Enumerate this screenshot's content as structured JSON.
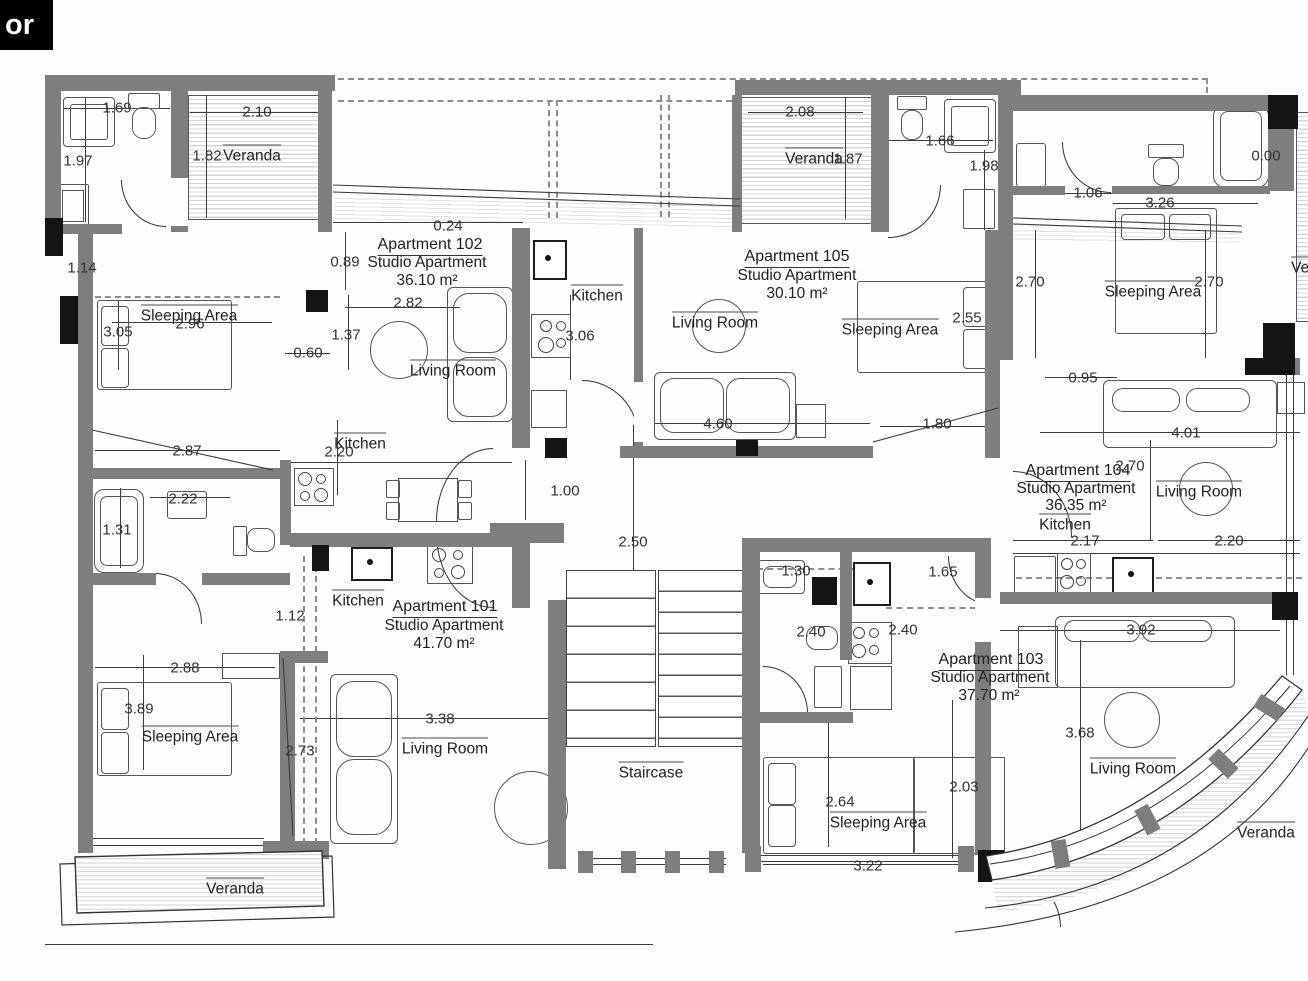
{
  "title_box": {
    "label": "or"
  },
  "apartments": [
    {
      "name": "Apartment 101",
      "type": "Studio Apartment",
      "area": "41.70 m²"
    },
    {
      "name": "Apartment 102",
      "type": "Studio Apartment",
      "area": "36.10 m²"
    },
    {
      "name": "Apartment 103",
      "type": "Studio Apartment",
      "area": "37.70 m²"
    },
    {
      "name": "Apartment 104",
      "type": "Studio Apartment",
      "area": "36.35 m²"
    },
    {
      "name": "Apartment 105",
      "type": "Studio Apartment",
      "area": "30.10 m²"
    }
  ],
  "room_types": [
    "Kitchen",
    "Living Room",
    "Sleeping Area",
    "Veranda",
    "Staircase"
  ],
  "labels": [
    {
      "t": "Apartment 102",
      "x": 430,
      "y": 246,
      "c": "apt"
    },
    {
      "t": "Studio Apartment",
      "x": 427,
      "y": 263,
      "c": "sub"
    },
    {
      "t": "36.10 m²",
      "x": 427,
      "y": 281,
      "c": "sub"
    },
    {
      "t": "Apartment 105",
      "x": 797,
      "y": 258,
      "c": "apt"
    },
    {
      "t": "Studio Apartment",
      "x": 797,
      "y": 276,
      "c": "sub"
    },
    {
      "t": "30.10 m²",
      "x": 797,
      "y": 294,
      "c": "sub"
    },
    {
      "t": "Apartment 104",
      "x": 1078,
      "y": 472,
      "c": "apt"
    },
    {
      "t": "Studio Apartment",
      "x": 1076,
      "y": 489,
      "c": "sub"
    },
    {
      "t": "36.35 m²",
      "x": 1076,
      "y": 506,
      "c": "sub"
    },
    {
      "t": "Apartment 101",
      "x": 445,
      "y": 608,
      "c": "apt"
    },
    {
      "t": "Studio Apartment",
      "x": 444,
      "y": 626,
      "c": "sub"
    },
    {
      "t": "41.70 m²",
      "x": 444,
      "y": 644,
      "c": "sub"
    },
    {
      "t": "Apartment 103",
      "x": 991,
      "y": 661,
      "c": "apt"
    },
    {
      "t": "Studio Apartment",
      "x": 990,
      "y": 678,
      "c": "sub"
    },
    {
      "t": "37.70 m²",
      "x": 989,
      "y": 696,
      "c": "sub"
    },
    {
      "t": "Veranda",
      "x": 252,
      "y": 155,
      "c": "room"
    },
    {
      "t": "Veranda",
      "x": 814,
      "y": 158,
      "c": "room"
    },
    {
      "t": "Veranda",
      "x": 235,
      "y": 888,
      "c": "room"
    },
    {
      "t": "Veranda",
      "x": 1266,
      "y": 832,
      "c": "room"
    },
    {
      "t": "Veranda",
      "x": 1320,
      "y": 267,
      "c": "room"
    },
    {
      "t": "Kitchen",
      "x": 597,
      "y": 295,
      "c": "room"
    },
    {
      "t": "Kitchen",
      "x": 360,
      "y": 443,
      "c": "room"
    },
    {
      "t": "Kitchen",
      "x": 358,
      "y": 600,
      "c": "room"
    },
    {
      "t": "Kitchen",
      "x": 1065,
      "y": 524,
      "c": "room"
    },
    {
      "t": "Living Room",
      "x": 453,
      "y": 370,
      "c": "room"
    },
    {
      "t": "Living Room",
      "x": 715,
      "y": 322,
      "c": "room"
    },
    {
      "t": "Living Room",
      "x": 1199,
      "y": 491,
      "c": "room"
    },
    {
      "t": "Living Room",
      "x": 445,
      "y": 748,
      "c": "room"
    },
    {
      "t": "Living Room",
      "x": 1133,
      "y": 768,
      "c": "room"
    },
    {
      "t": "Sleeping Area",
      "x": 189,
      "y": 315,
      "c": "room"
    },
    {
      "t": "Sleeping Area",
      "x": 890,
      "y": 329,
      "c": "room"
    },
    {
      "t": "Sleeping Area",
      "x": 1153,
      "y": 291,
      "c": "room"
    },
    {
      "t": "Sleeping Area",
      "x": 190,
      "y": 736,
      "c": "room"
    },
    {
      "t": "Sleeping Area",
      "x": 878,
      "y": 822,
      "c": "room"
    },
    {
      "t": "Staircase",
      "x": 651,
      "y": 772,
      "c": "room"
    },
    {
      "t": "1.69",
      "x": 117,
      "y": 108,
      "c": "dim"
    },
    {
      "t": "2.10",
      "x": 257,
      "y": 112,
      "c": "dim"
    },
    {
      "t": "1.82",
      "x": 207,
      "y": 156,
      "c": "dim"
    },
    {
      "t": "1.97",
      "x": 78,
      "y": 161,
      "c": "dim"
    },
    {
      "t": "1.14",
      "x": 82,
      "y": 268,
      "c": "dim"
    },
    {
      "t": "0.24",
      "x": 448,
      "y": 226,
      "c": "dim"
    },
    {
      "t": "0.89",
      "x": 345,
      "y": 262,
      "c": "dim"
    },
    {
      "t": "2.82",
      "x": 408,
      "y": 303,
      "c": "dim"
    },
    {
      "t": "1.37",
      "x": 346,
      "y": 335,
      "c": "dim"
    },
    {
      "t": "0.60",
      "x": 308,
      "y": 353,
      "c": "dim"
    },
    {
      "t": "3.05",
      "x": 118,
      "y": 332,
      "c": "dim"
    },
    {
      "t": "2.96",
      "x": 190,
      "y": 324,
      "c": "dim"
    },
    {
      "t": "3.06",
      "x": 580,
      "y": 336,
      "c": "dim"
    },
    {
      "t": "2.87",
      "x": 187,
      "y": 451,
      "c": "dim"
    },
    {
      "t": "2.20",
      "x": 339,
      "y": 452,
      "c": "dim"
    },
    {
      "t": "2.22",
      "x": 183,
      "y": 499,
      "c": "dim"
    },
    {
      "t": "1.31",
      "x": 117,
      "y": 530,
      "c": "dim"
    },
    {
      "t": "1.12",
      "x": 290,
      "y": 616,
      "c": "dim"
    },
    {
      "t": "2.88",
      "x": 185,
      "y": 668,
      "c": "dim"
    },
    {
      "t": "3.89",
      "x": 139,
      "y": 709,
      "c": "dim"
    },
    {
      "t": "2.73",
      "x": 300,
      "y": 751,
      "c": "dim"
    },
    {
      "t": "3.38",
      "x": 440,
      "y": 719,
      "c": "dim"
    },
    {
      "t": "1.00",
      "x": 565,
      "y": 491,
      "c": "dim"
    },
    {
      "t": "2.50",
      "x": 633,
      "y": 542,
      "c": "dim"
    },
    {
      "t": "2.08",
      "x": 800,
      "y": 112,
      "c": "dim"
    },
    {
      "t": "1.87",
      "x": 848,
      "y": 159,
      "c": "dim"
    },
    {
      "t": "1.66",
      "x": 940,
      "y": 141,
      "c": "dim"
    },
    {
      "t": "1.98",
      "x": 984,
      "y": 166,
      "c": "dim"
    },
    {
      "t": "1.06",
      "x": 1088,
      "y": 193,
      "c": "dim"
    },
    {
      "t": "3.26",
      "x": 1160,
      "y": 203,
      "c": "dim"
    },
    {
      "t": "0.00",
      "x": 1266,
      "y": 156,
      "c": "dim"
    },
    {
      "t": "2.70",
      "x": 1030,
      "y": 282,
      "c": "dim"
    },
    {
      "t": "2.70",
      "x": 1209,
      "y": 282,
      "c": "dim"
    },
    {
      "t": "2.55",
      "x": 967,
      "y": 318,
      "c": "dim"
    },
    {
      "t": "4.60",
      "x": 718,
      "y": 424,
      "c": "dim"
    },
    {
      "t": "1.80",
      "x": 937,
      "y": 424,
      "c": "dim"
    },
    {
      "t": "0.95",
      "x": 1083,
      "y": 378,
      "c": "dim"
    },
    {
      "t": "4.01",
      "x": 1186,
      "y": 433,
      "c": "dim"
    },
    {
      "t": "2.70",
      "x": 1130,
      "y": 466,
      "c": "dim"
    },
    {
      "t": "2.17",
      "x": 1085,
      "y": 541,
      "c": "dim"
    },
    {
      "t": "2.20",
      "x": 1229,
      "y": 541,
      "c": "dim"
    },
    {
      "t": "1.30",
      "x": 796,
      "y": 571,
      "c": "dim"
    },
    {
      "t": "1.65",
      "x": 943,
      "y": 572,
      "c": "dim"
    },
    {
      "t": "2.40",
      "x": 811,
      "y": 632,
      "c": "dim"
    },
    {
      "t": "2.40",
      "x": 903,
      "y": 630,
      "c": "dim"
    },
    {
      "t": "2.64",
      "x": 840,
      "y": 802,
      "c": "dim"
    },
    {
      "t": "3.22",
      "x": 868,
      "y": 866,
      "c": "dim"
    },
    {
      "t": "2.03",
      "x": 964,
      "y": 787,
      "c": "dim"
    },
    {
      "t": "3.68",
      "x": 1080,
      "y": 733,
      "c": "dim"
    },
    {
      "t": "3.92",
      "x": 1141,
      "y": 630,
      "c": "dim"
    }
  ]
}
